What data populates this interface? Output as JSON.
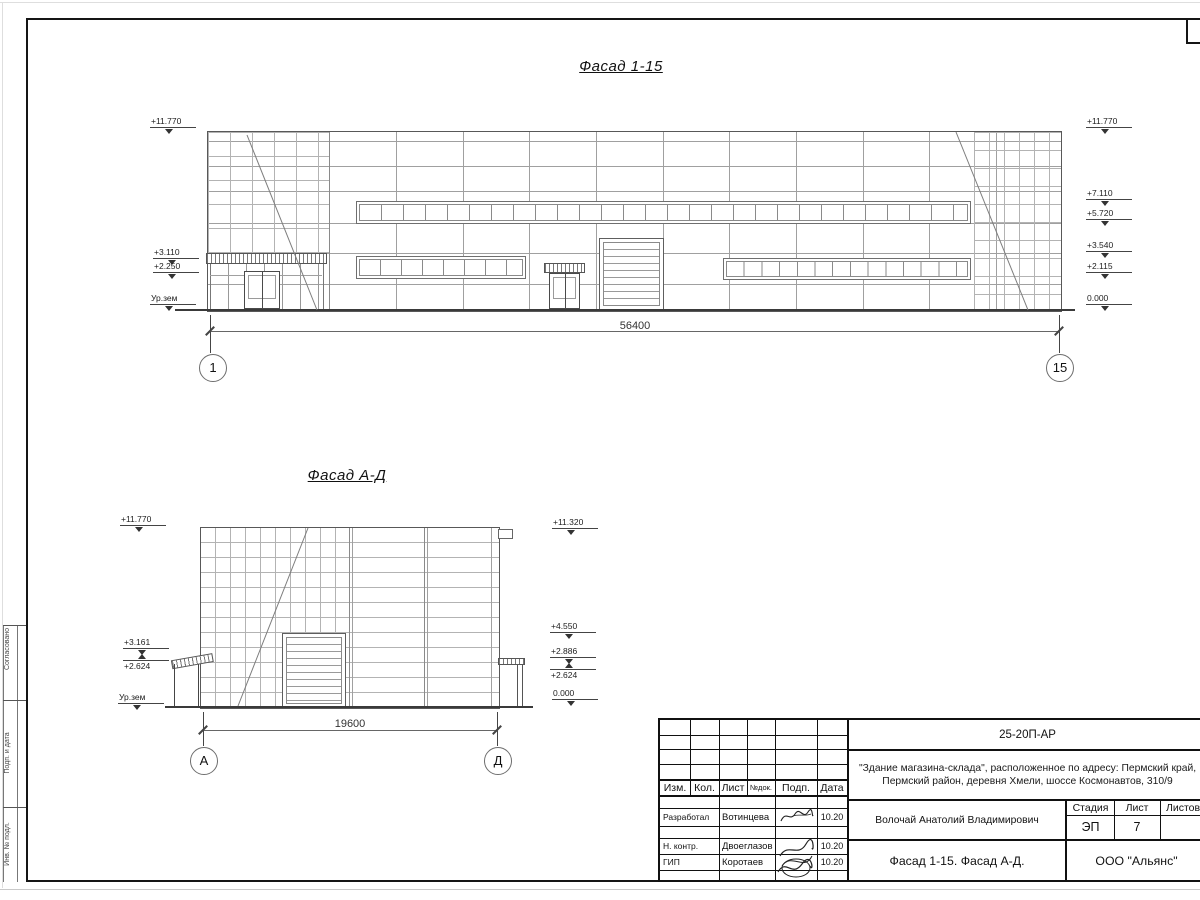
{
  "facade_1_15": {
    "title": "Фасад 1-15",
    "dimension": "56400",
    "axis_left": "1",
    "axis_right": "15",
    "marks_left": [
      "+11.770",
      "+3.110",
      "+2.250",
      "Ур.зем"
    ],
    "marks_right": [
      "+11.770",
      "+7.110",
      "+5.720",
      "+3.540",
      "+2.115",
      "0.000"
    ]
  },
  "facade_a_d": {
    "title": "Фасад А-Д",
    "dimension": "19600",
    "axis_left": "А",
    "axis_right": "Д",
    "marks_left": [
      "+11.770",
      "+3.161",
      "+2.624",
      "Ур.зем"
    ],
    "marks_right": [
      "+11.320",
      "+4.550",
      "+2.886",
      "+2.624",
      "0.000"
    ]
  },
  "title_block": {
    "doc_number": "25-20П-АР",
    "project_line1": "\"Здание магазина-склада\", расположенное по адресу: Пермский край,",
    "project_line2": "Пермский район, деревня Хмели, шоссе Космонавтов, 310/9",
    "header_cols": [
      "Изм.",
      "Кол.",
      "Лист",
      "№док.",
      "Подп.",
      "Дата"
    ],
    "rows": [
      {
        "role": "Разработал",
        "name": "Вотинцева",
        "date": "10.20"
      },
      {
        "role": "Н. контр.",
        "name": "Двоеглазов",
        "date": "10.20"
      },
      {
        "role": "ГИП",
        "name": "Коротаев",
        "date": "10.20"
      }
    ],
    "chief": "Волочай Анатолий Владимирович",
    "stage_label": "Стадия",
    "stage": "ЭП",
    "sheet_label": "Лист",
    "sheet": "7",
    "sheets_label": "Листов",
    "drawing_name": "Фасад 1-15. Фасад А-Д.",
    "company": "ООО \"Альянс\""
  },
  "side_strip": {
    "labels": [
      "Согласовано",
      "Подп. и дата",
      "Инв. № подл."
    ]
  }
}
